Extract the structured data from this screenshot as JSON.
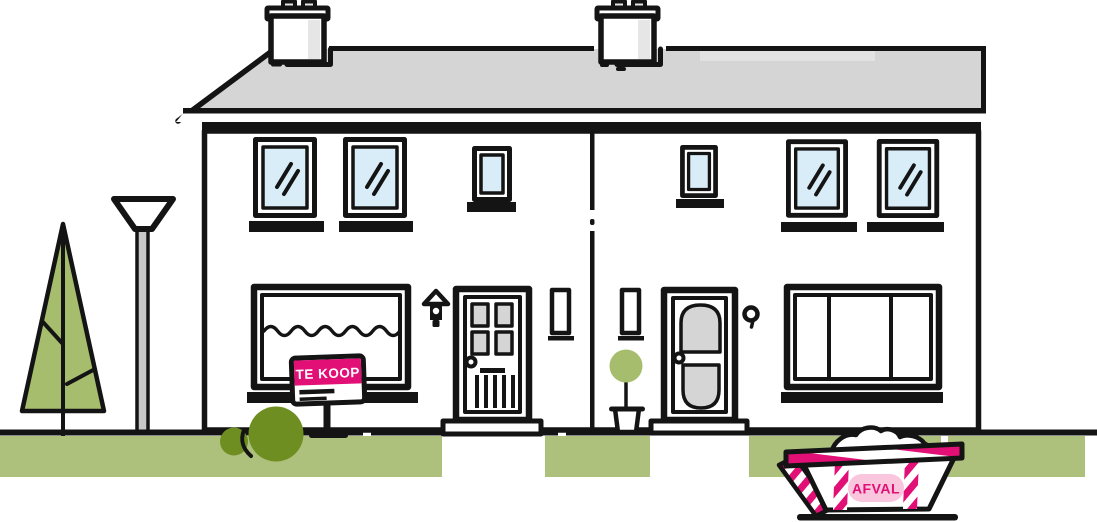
{
  "scene": {
    "title": "Semi-detached houses street illustration",
    "sign": {
      "label": "TE KOOP"
    },
    "skip": {
      "label": "AFVAL"
    }
  },
  "colors": {
    "ink": "#141414",
    "accent": "#e20f76",
    "accent-light": "#f9c6de",
    "grass": "#adc07c",
    "tree": "#a6bd6d",
    "bush": "#6e8e21",
    "glass": "#d9edf9",
    "roof": "#d5d5d5",
    "roof-highlight": "#e2e2e2",
    "metal": "#c8c8c8",
    "panel": "#d5d5d5",
    "white": "#ffffff"
  }
}
